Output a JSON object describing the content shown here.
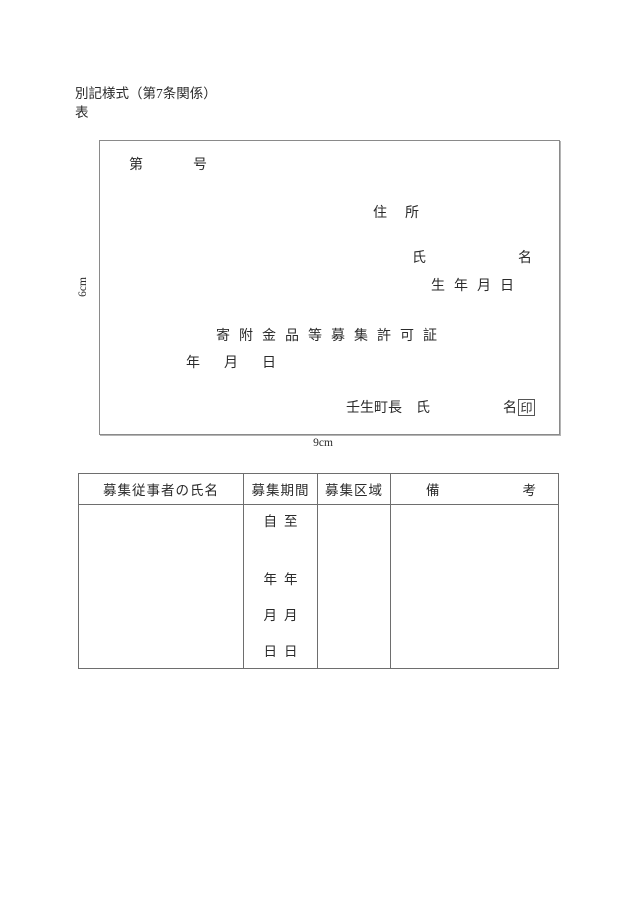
{
  "page": {
    "form_style_note": "別記様式（第7条関係）",
    "side_label": "表"
  },
  "certificate": {
    "number_prefix": "第",
    "number_suffix": "号",
    "address_label": "住所",
    "name_label_left": "氏",
    "name_label_right": "名",
    "birthdate_label": "生年月日",
    "title": "寄附金品等募集許可証",
    "date_label": "年月日",
    "issuer_label": "壬生町長　氏",
    "issuer_suffix": "名",
    "seal_label": "印",
    "height_dimension": "6cm",
    "width_dimension": "9cm"
  },
  "table": {
    "headers": {
      "name": "募集従事者の氏名",
      "period": "募集期間",
      "area": "募集区域",
      "remarks_left": "備",
      "remarks_right": "考"
    },
    "period_columns": {
      "from": [
        "自",
        "年",
        "月",
        "日"
      ],
      "to": [
        "至",
        "年",
        "月",
        "日"
      ]
    }
  }
}
